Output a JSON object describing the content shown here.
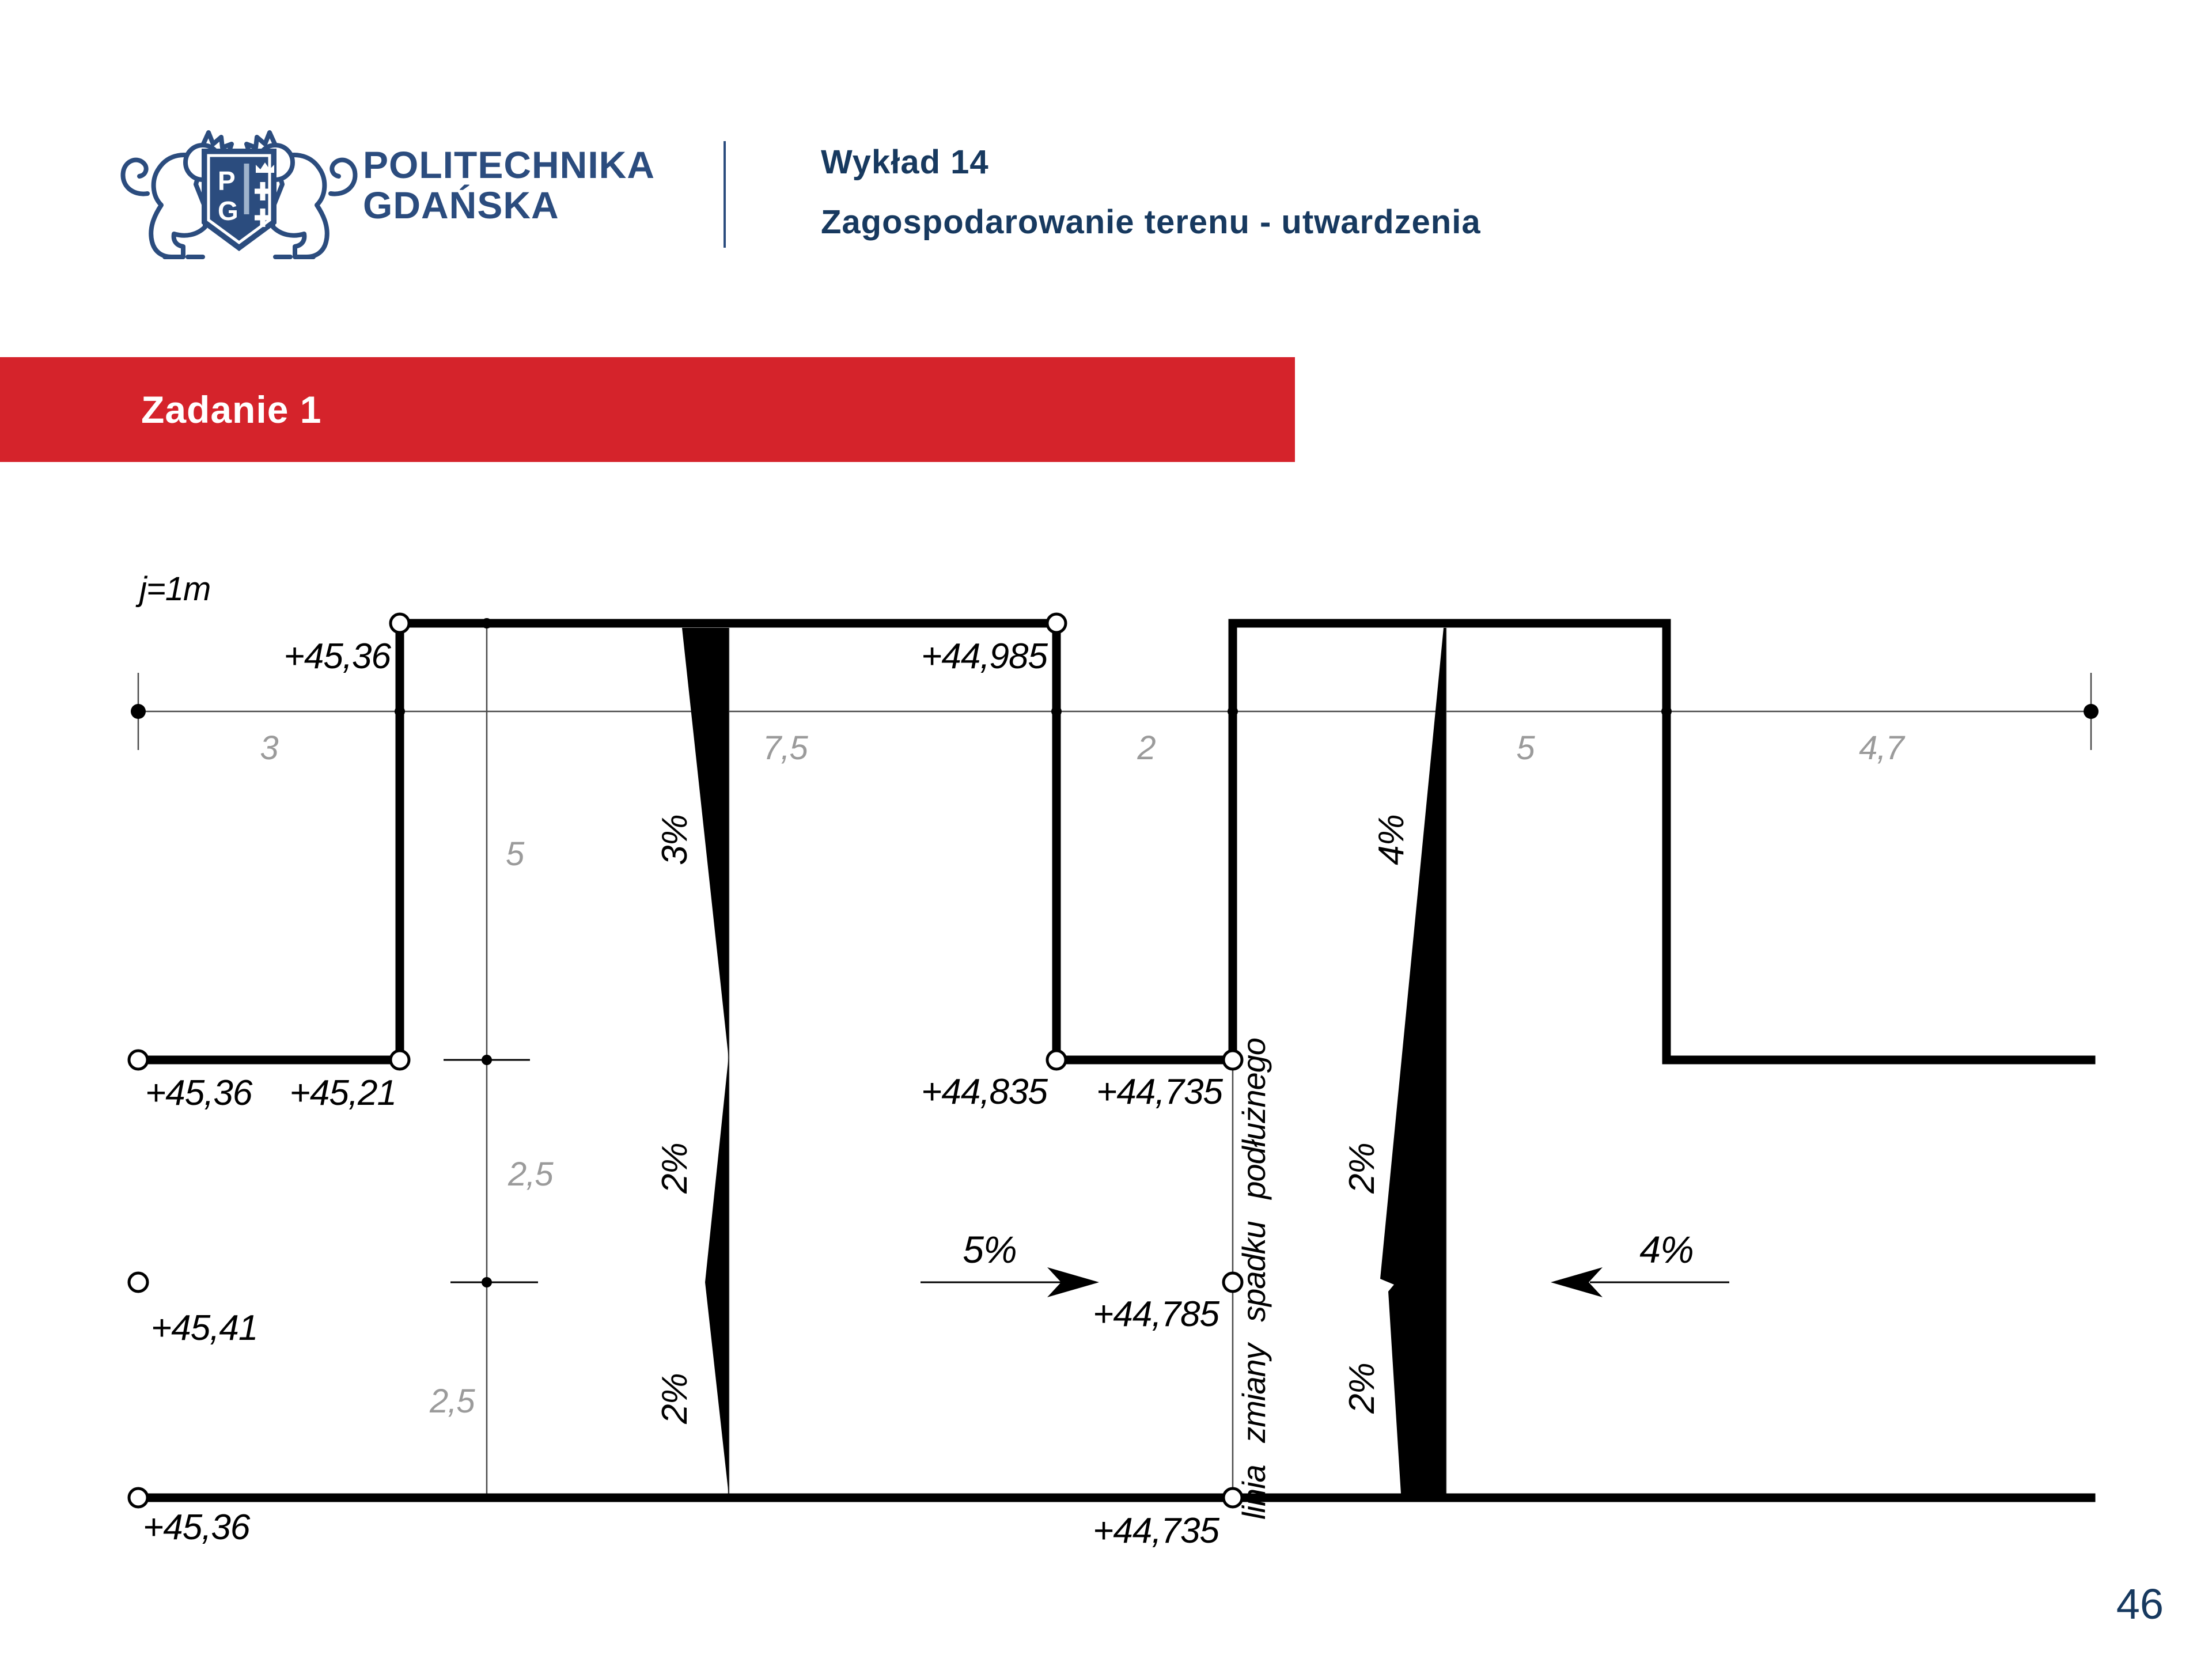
{
  "colors": {
    "navy": "#17395f",
    "logo_navy": "#2b4c7e",
    "red": "#d5232b",
    "dim_gray": "#9b9b9b"
  },
  "header": {
    "brand_line1": "POLITECHNIKA",
    "brand_line2": "GDAŃSKA",
    "logo_shield_letters": "PG",
    "lecture_title": "Wykład 14",
    "lecture_subtitle": "Zagospodarowanie terenu - utwardzenia"
  },
  "banner": {
    "title": "Zadanie 1"
  },
  "footer": {
    "page_number": "46"
  },
  "drawing": {
    "scale_label": "j=1m",
    "elevations": {
      "top_left": "+45,36",
      "top_right": "+44,985",
      "mid_left_a": "+45,36",
      "mid_left_b": "+45,21",
      "mid_right_a": "+44,835",
      "mid_right_b": "+44,735",
      "row3_left": "+45,41",
      "row3_right": "+44,785",
      "bottom_left": "+45,36",
      "bottom_right": "+44,735"
    },
    "h_dimensions": [
      "3",
      "7,5",
      "2",
      "5",
      "4,7"
    ],
    "v_dimensions": [
      "5",
      "2,5",
      "2,5"
    ],
    "slope_labels": {
      "left_col_top": "3%",
      "left_col_mid": "2%",
      "left_col_bottom": "2%",
      "right_col_top": "4%",
      "right_col_mid": "2%",
      "right_col_bottom": "2%",
      "arrow_right_label": "5%",
      "arrow_left_label": "4%"
    },
    "vertical_note": "linia zmiany spadku podłużnego"
  }
}
